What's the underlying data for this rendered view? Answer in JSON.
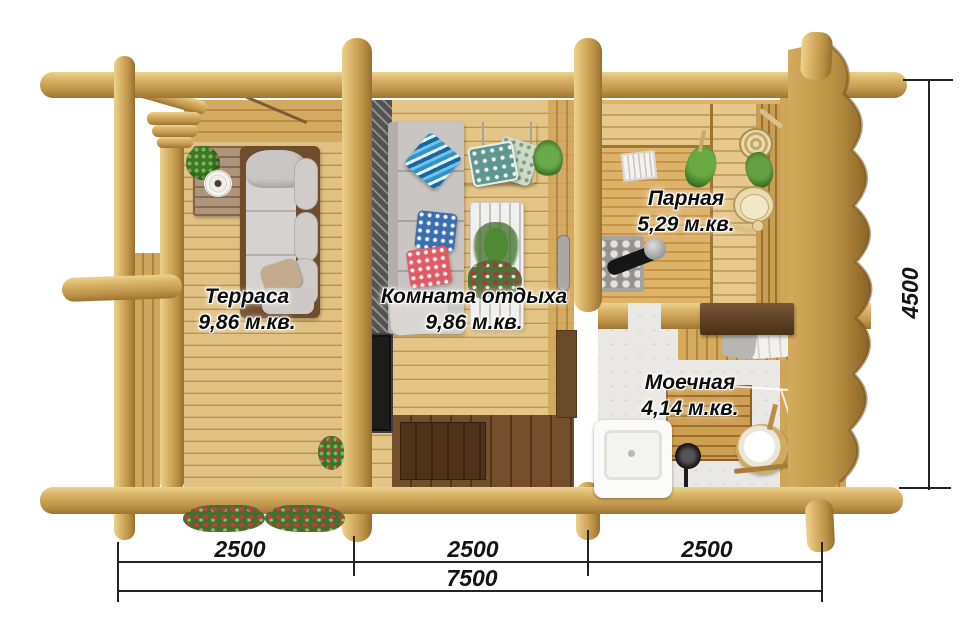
{
  "plan": {
    "rooms": [
      {
        "name": "Терраса",
        "area": "9,86 м.кв."
      },
      {
        "name": "Комната отдыха",
        "area": "9,86 м.кв."
      },
      {
        "name": "Парная",
        "area": "5,29 м.кв."
      },
      {
        "name": "Моечная",
        "area": "4,14 м.кв."
      }
    ],
    "dimensions": {
      "width_segments": [
        "2500",
        "2500",
        "2500"
      ],
      "width_total": "7500",
      "depth": "4500"
    },
    "colors": {
      "wood_light": "#e0c184",
      "wood_log": "#c0954a",
      "wood_dark": "#8a6128",
      "tile": "#e9e8e4",
      "label_text": "#0d0d0d"
    }
  }
}
